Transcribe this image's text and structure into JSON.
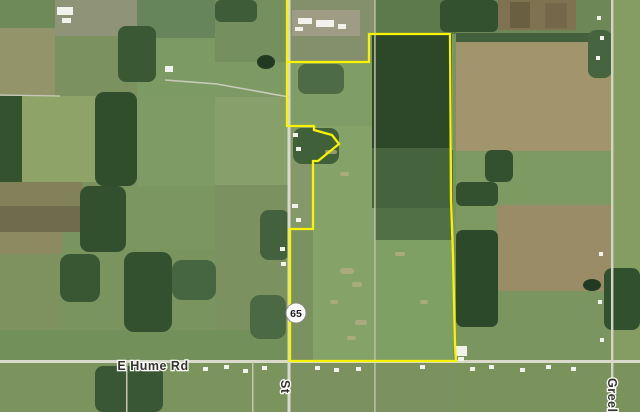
{
  "map": {
    "description": "Aerial satellite view of rural farmland with a parcel outlined in yellow",
    "labels": {
      "hume_road": "E Hume Rd",
      "greely_road": "Greely",
      "center_road": "St",
      "route_shield": "65"
    },
    "colors": {
      "parcel_boundary": "#f8f400",
      "road": "#d9dacb",
      "label_text": "#35352c",
      "label_halo": "#ffffff",
      "shield_fill": "#ffffff",
      "shield_border": "#8d8d85",
      "shield_text": "#1d1d1d",
      "field_base": "#7b9160",
      "forest": "#2f4c2c",
      "tan_field": "#a2956d"
    },
    "parcel_boundary_path": "M287,0 L287,126 L314,126 L314,130 L332,135 L339,144 L318,161 L313,161 L313,229 L290,229 L290,361 L456,361 L455,345 L453,255 L451,200 L450,34 L369,34 L369,62 L287,62"
  }
}
